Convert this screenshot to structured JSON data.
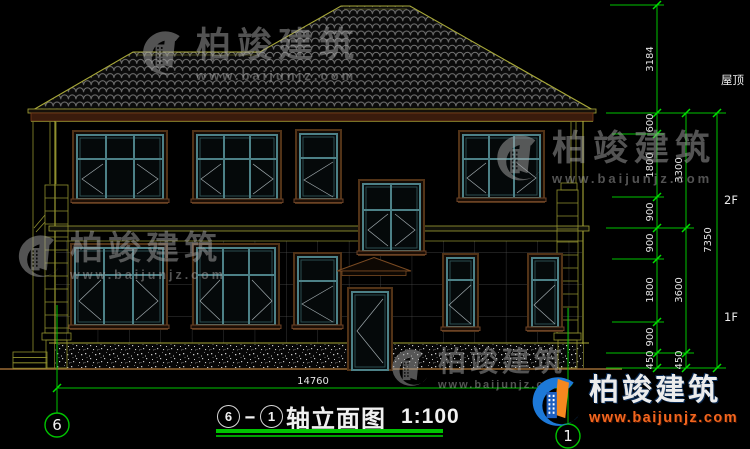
{
  "watermark": {
    "brand": "柏竣建筑",
    "site": "www.baijunjz.com"
  },
  "brand_footer": {
    "brand": "柏竣建筑",
    "site": "www.baijunjz.com"
  },
  "dims": {
    "inner": [
      "3184",
      "600",
      "1800",
      "900",
      "900",
      "1800",
      "900",
      "450"
    ],
    "mid": [
      "3300",
      "3600",
      "450"
    ],
    "outer": [
      "7350"
    ],
    "width": "14760"
  },
  "levels": {
    "roof": "屋顶",
    "f2": "2F",
    "f1": "1F"
  },
  "axes": {
    "left": "6",
    "right": "1"
  },
  "titlebar": {
    "from": "6",
    "dash": "-",
    "to": "1",
    "label": "轴立面图",
    "scale": "1:100"
  }
}
